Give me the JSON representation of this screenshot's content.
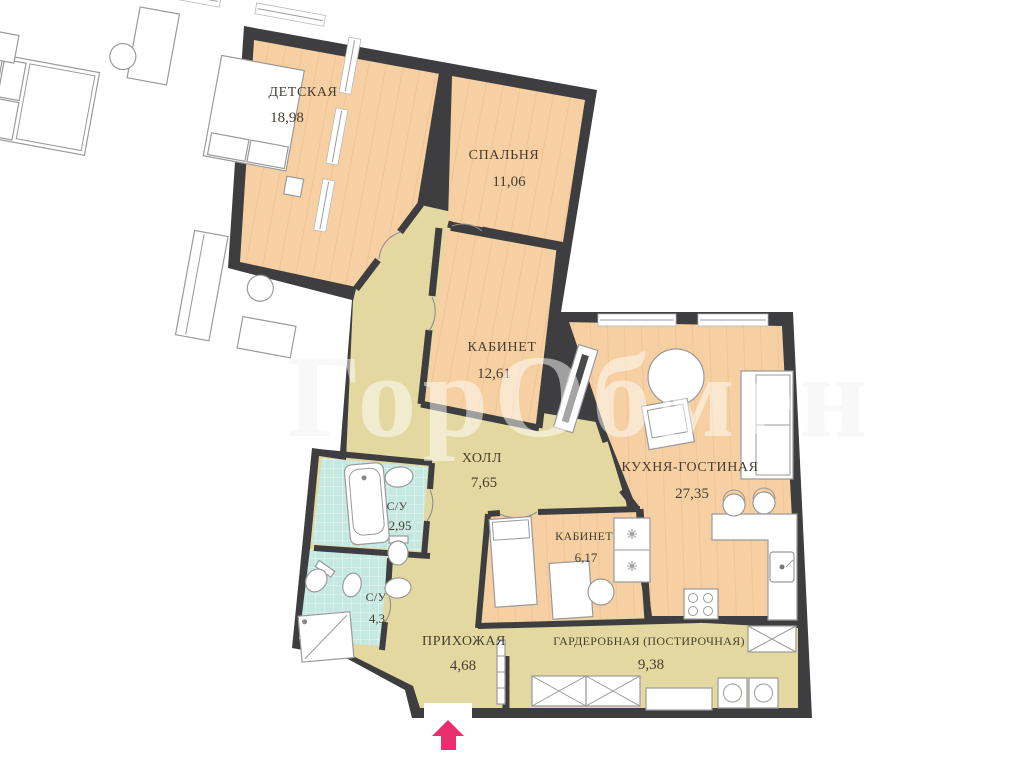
{
  "title": "Apartment floor plan",
  "watermark": "ГорОбмен",
  "rooms": [
    {
      "name": "ДЕТСКАЯ",
      "area": "18,98"
    },
    {
      "name": "СПАЛЬНЯ",
      "area": "11,06"
    },
    {
      "name": "КАБИНЕТ",
      "area": "12,61"
    },
    {
      "name": "ХОЛЛ",
      "area": "7,65"
    },
    {
      "name": "КУХНЯ-ГОСТИНАЯ",
      "area": "27,35"
    },
    {
      "name": "КАБИНЕТ",
      "area": "6,17"
    },
    {
      "name": "С/У",
      "area": "2,95"
    },
    {
      "name": "С/У",
      "area": "4,3"
    },
    {
      "name": "ПРИХОЖАЯ",
      "area": "4,68"
    },
    {
      "name": "ГАРДЕРОБНАЯ (ПОСТИРОЧНАЯ)",
      "area": "9,38"
    }
  ],
  "colors": {
    "wall": "#3e3e40",
    "room_floor": "#f6d0a2",
    "hall_floor": "#e3d9a0",
    "bath_floor": "#c5e8e1",
    "label": "#463e33",
    "entrance_arrow": "#ea306c"
  }
}
